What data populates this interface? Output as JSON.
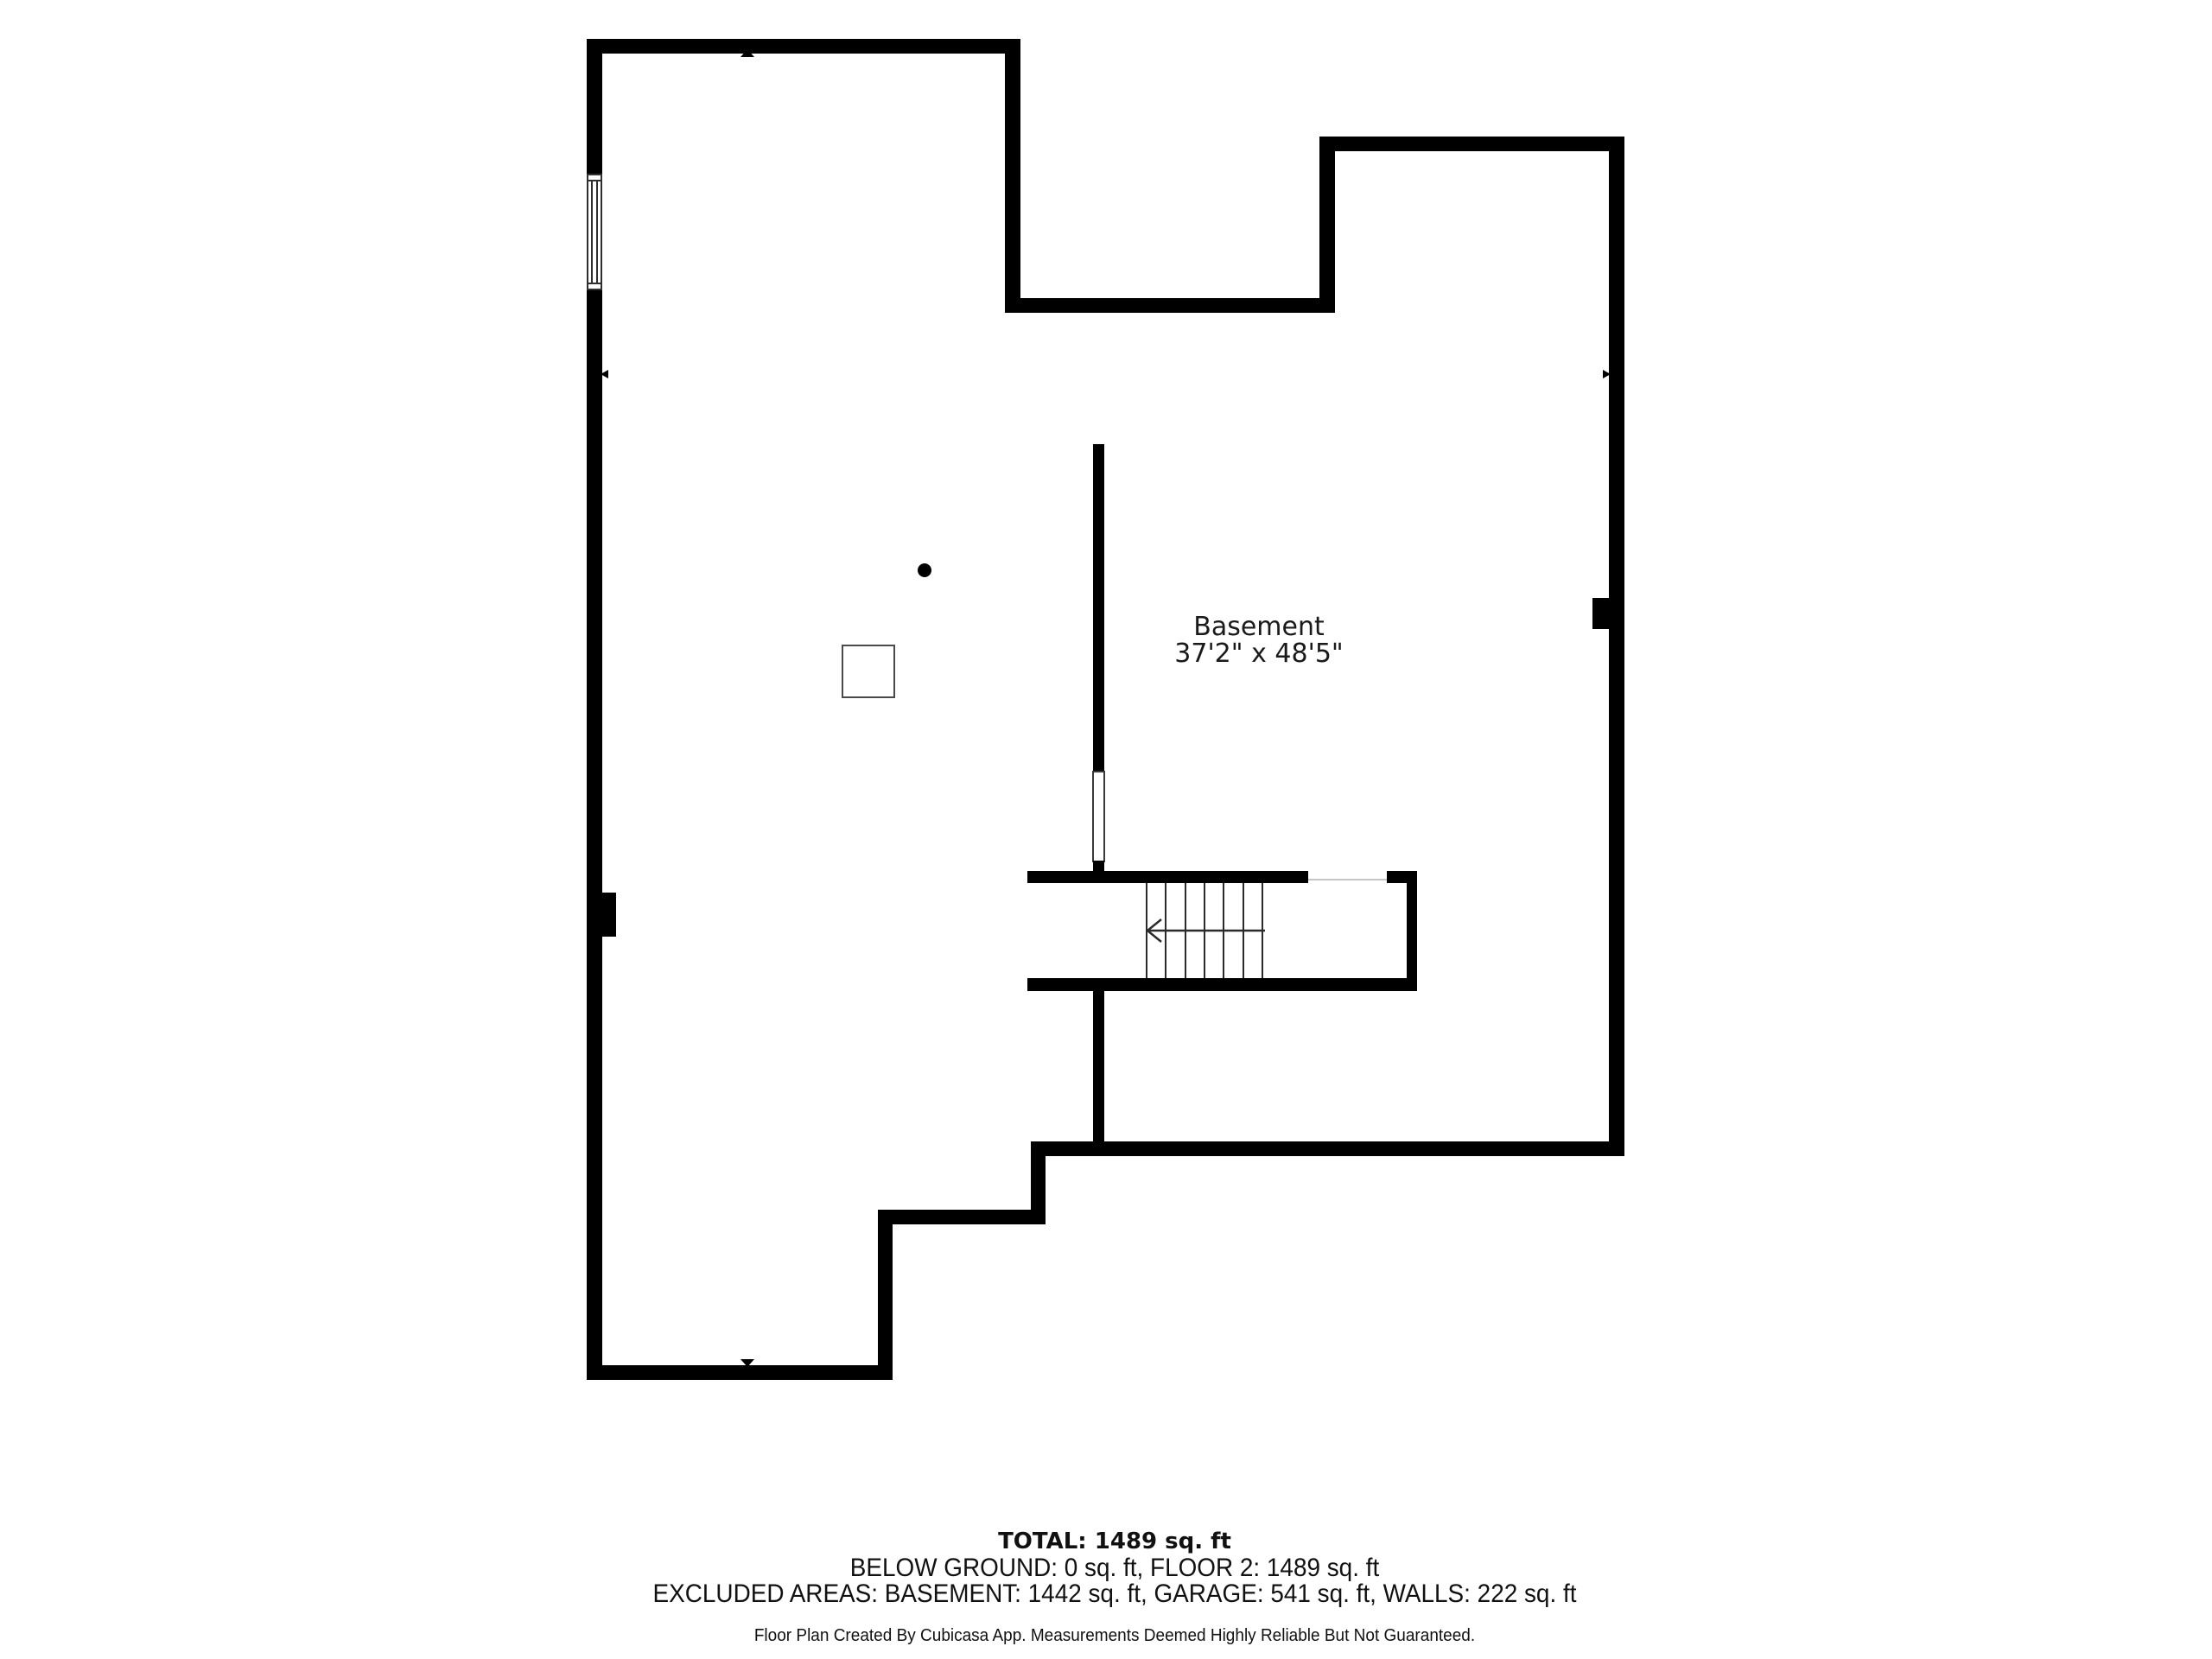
{
  "room": {
    "name": "Basement",
    "dimensions": "37'2\" x 48'5\""
  },
  "footer": {
    "total": "TOTAL: 1489 sq. ft",
    "areas": "BELOW GROUND: 0 sq. ft, FLOOR 2: 1489 sq. ft",
    "excluded": "EXCLUDED AREAS: BASEMENT: 1442 sq. ft, GARAGE: 541 sq. ft, WALLS: 222 sq. ft",
    "disclaimer": "Floor Plan Created By Cubicasa App. Measurements Deemed Highly Reliable But Not Guaranteed."
  },
  "stairs": {
    "tread_count": 6,
    "direction": "left"
  },
  "colors": {
    "wall": "#000000",
    "background": "#ffffff",
    "stair_line": "#2b2b2b"
  }
}
